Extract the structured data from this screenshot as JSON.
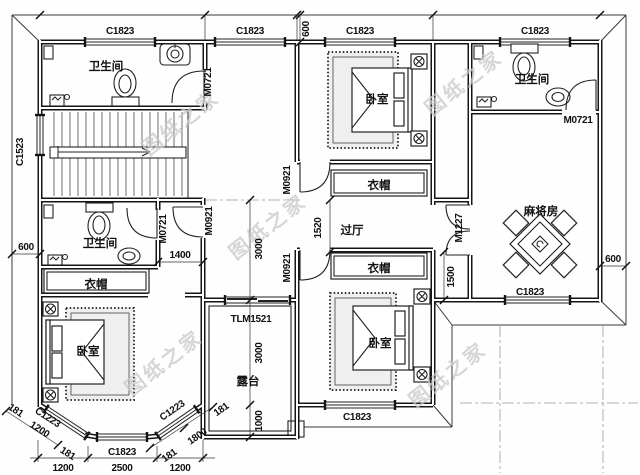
{
  "watermark": {
    "text": "图纸之家"
  },
  "rooms": {
    "bathroom": "卫生间",
    "bedroom": "卧室",
    "closet": "衣帽",
    "hallway": "过厅",
    "mahjong_room": "麻将房",
    "terrace": "露台"
  },
  "openings": {
    "window_c1823": "C1823",
    "window_c1523": "C1523",
    "window_c1223": "C1223",
    "door_m0721": "M0721",
    "door_m0921": "M0921",
    "door_m1227": "M1227",
    "door_tlm1521": "TLM1521"
  },
  "dimensions": {
    "d600": "600",
    "d1000": "1000",
    "d1200": "1200",
    "d1400": "1400",
    "d1500": "1500",
    "d1520": "1520",
    "d1800": "1800",
    "d2500": "2500",
    "d3000": "3000",
    "d181": "181"
  }
}
